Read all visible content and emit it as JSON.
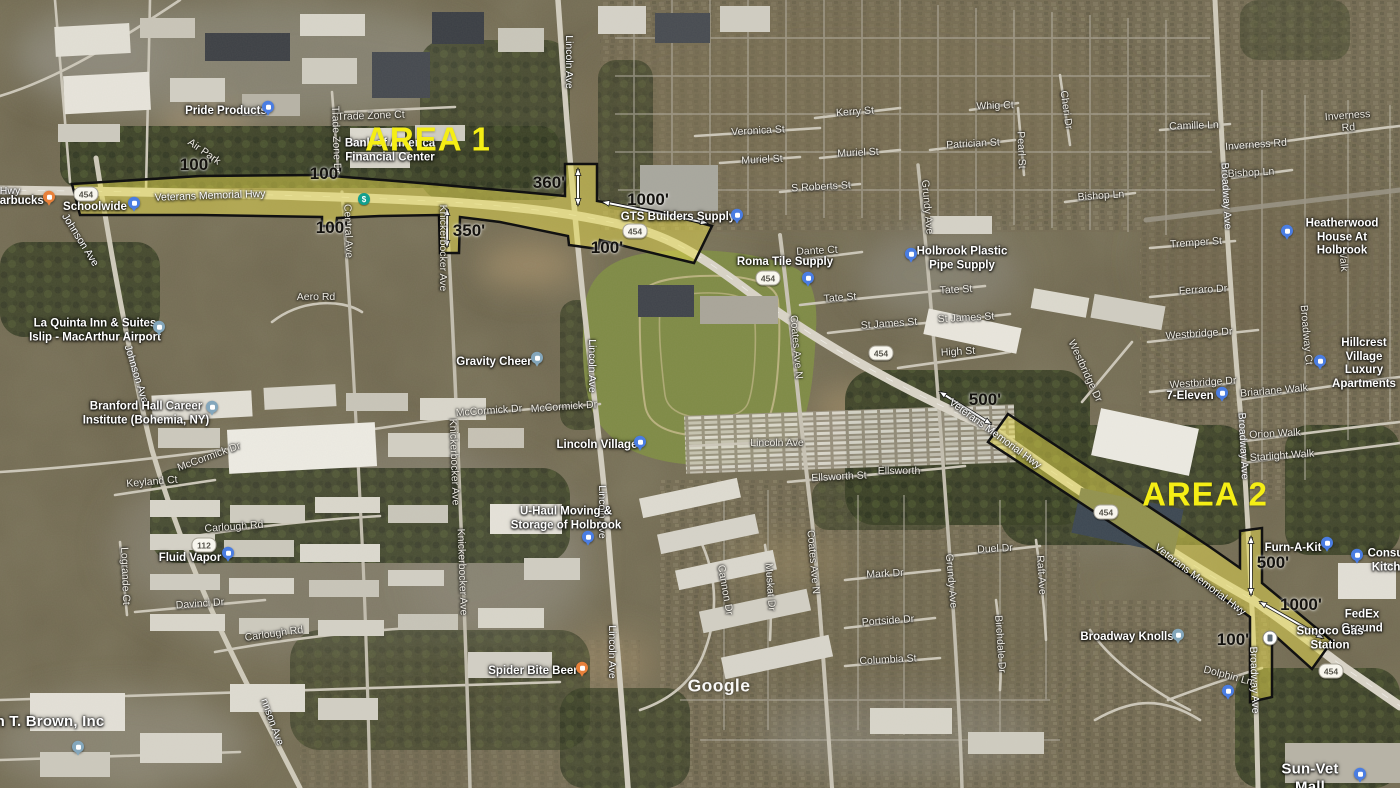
{
  "map": {
    "watermark": "Google",
    "colors": {
      "corridor_fill": "#e8dc4e",
      "corridor_outline": "#111111",
      "area_label": "#f5ee15",
      "arrow": "#ffffff",
      "route_shield_bg": "#f8f6ee"
    },
    "area_labels": [
      {
        "name": "area-1-label",
        "text": "AREA 1",
        "x": 428,
        "y": 140
      },
      {
        "name": "area-2-label",
        "text": "AREA 2",
        "x": 1205,
        "y": 495
      }
    ],
    "measurements": [
      {
        "text": "100'",
        "x": 196,
        "y": 165
      },
      {
        "text": "100'",
        "x": 326,
        "y": 174
      },
      {
        "text": "100'",
        "x": 332,
        "y": 228
      },
      {
        "text": "350'",
        "x": 469,
        "y": 231
      },
      {
        "text": "360'",
        "x": 549,
        "y": 183
      },
      {
        "text": "100'",
        "x": 607,
        "y": 248
      },
      {
        "text": "1000'",
        "x": 648,
        "y": 200
      },
      {
        "text": "500'",
        "x": 985,
        "y": 400
      },
      {
        "text": "500'",
        "x": 1273,
        "y": 563
      },
      {
        "text": "1000'",
        "x": 1301,
        "y": 605
      },
      {
        "text": "100'",
        "x": 1233,
        "y": 640
      }
    ],
    "route_shields": [
      {
        "text": "454",
        "x": 86,
        "y": 194
      },
      {
        "text": "454",
        "x": 635,
        "y": 231
      },
      {
        "text": "454",
        "x": 768,
        "y": 278
      },
      {
        "text": "454",
        "x": 881,
        "y": 353
      },
      {
        "text": "454",
        "x": 1106,
        "y": 512
      },
      {
        "text": "454",
        "x": 1331,
        "y": 671
      },
      {
        "text": "112",
        "x": 204,
        "y": 545
      }
    ],
    "street_labels": [
      {
        "text": "Hwy",
        "x": 10,
        "y": 191,
        "rot": 0,
        "cls": "onroad"
      },
      {
        "text": "Veterans Memorial Hwy",
        "x": 210,
        "y": 196,
        "rot": -2,
        "cls": "onroad"
      },
      {
        "text": "Veterans Memorial Hwy",
        "x": 995,
        "y": 434,
        "rot": 36,
        "cls": "onroad"
      },
      {
        "text": "Veterans Memorial Hwy",
        "x": 1200,
        "y": 580,
        "rot": 37,
        "cls": "onroad"
      },
      {
        "text": "Johnson Ave",
        "x": 80,
        "y": 240,
        "rot": 58,
        "cls": "onroad"
      },
      {
        "text": "Johnson Ave",
        "x": 136,
        "y": 374,
        "rot": 73,
        "cls": "onroad"
      },
      {
        "text": "nnson Ave",
        "x": 272,
        "y": 722,
        "rot": 70,
        "cls": "onroad"
      },
      {
        "text": "Lincoln Ave",
        "x": 569,
        "y": 62,
        "rot": 90,
        "cls": "onroad"
      },
      {
        "text": "Lincoln Ave",
        "x": 592,
        "y": 366,
        "rot": 90,
        "cls": "onroad"
      },
      {
        "text": "Lincoln Ave",
        "x": 602,
        "y": 512,
        "rot": 90,
        "cls": "onroad"
      },
      {
        "text": "Lincoln Ave",
        "x": 612,
        "y": 652,
        "rot": 90,
        "cls": "onroad"
      },
      {
        "text": "Broadway Ave",
        "x": 1226,
        "y": 196,
        "rot": 87,
        "cls": "onroad"
      },
      {
        "text": "Broadway Ave",
        "x": 1243,
        "y": 446,
        "rot": 87,
        "cls": "onroad"
      },
      {
        "text": "Broadway Ave",
        "x": 1254,
        "y": 680,
        "rot": 88,
        "cls": "onroad"
      },
      {
        "text": "Coates Ave N",
        "x": 796,
        "y": 347,
        "rot": 85
      },
      {
        "text": "Coates Ave N",
        "x": 813,
        "y": 562,
        "rot": 85
      },
      {
        "text": "Grundy Ave",
        "x": 927,
        "y": 207,
        "rot": 85
      },
      {
        "text": "Grundy Ave",
        "x": 951,
        "y": 581,
        "rot": 85
      },
      {
        "text": "Knickerbocker Ave",
        "x": 443,
        "y": 248,
        "rot": 90
      },
      {
        "text": "Knickerbocker Ave",
        "x": 454,
        "y": 462,
        "rot": 88
      },
      {
        "text": "Knickerbocker Ave",
        "x": 462,
        "y": 572,
        "rot": 88
      },
      {
        "text": "Central Ave",
        "x": 348,
        "y": 231,
        "rot": 88
      },
      {
        "text": "Trade Zone Dr",
        "x": 336,
        "y": 140,
        "rot": 88
      },
      {
        "text": "Trade Zone Ct",
        "x": 371,
        "y": 116,
        "rot": -2
      },
      {
        "text": "Air Park",
        "x": 204,
        "y": 152,
        "rot": 35
      },
      {
        "text": "Aero Rd",
        "x": 316,
        "y": 297,
        "rot": 0
      },
      {
        "text": "McCormick Dr",
        "x": 209,
        "y": 457,
        "rot": -20
      },
      {
        "text": "McCormick Dr",
        "x": 489,
        "y": 411,
        "rot": -4
      },
      {
        "text": "McCormick Dr",
        "x": 564,
        "y": 407,
        "rot": -4
      },
      {
        "text": "Keyland Ct",
        "x": 152,
        "y": 482,
        "rot": -5
      },
      {
        "text": "Carlough Rd",
        "x": 234,
        "y": 527,
        "rot": -4
      },
      {
        "text": "Carlough Rd",
        "x": 274,
        "y": 634,
        "rot": -8
      },
      {
        "text": "Davinci Dr",
        "x": 200,
        "y": 604,
        "rot": -4
      },
      {
        "text": "Logrande Ct",
        "x": 125,
        "y": 576,
        "rot": 88
      },
      {
        "text": "Veronica St",
        "x": 758,
        "y": 131,
        "rot": -3
      },
      {
        "text": "Muriel St",
        "x": 762,
        "y": 160,
        "rot": -3
      },
      {
        "text": "Muriel St",
        "x": 858,
        "y": 153,
        "rot": -3
      },
      {
        "text": "Kerry St",
        "x": 855,
        "y": 112,
        "rot": -4
      },
      {
        "text": "S Roberts St",
        "x": 821,
        "y": 187,
        "rot": -3
      },
      {
        "text": "Whig Ct",
        "x": 995,
        "y": 106,
        "rot": -2
      },
      {
        "text": "Patrician St",
        "x": 973,
        "y": 144,
        "rot": -3
      },
      {
        "text": "Pearl St",
        "x": 1021,
        "y": 150,
        "rot": 88
      },
      {
        "text": "Cheri Dr",
        "x": 1066,
        "y": 110,
        "rot": 82
      },
      {
        "text": "Camille Ln",
        "x": 1194,
        "y": 126,
        "rot": -2
      },
      {
        "text": "Inverness Rd",
        "x": 1256,
        "y": 145,
        "rot": -4
      },
      {
        "text": "Inverness Rd",
        "x": 1348,
        "y": 122,
        "rot": -4
      },
      {
        "text": "Bishop Ln",
        "x": 1251,
        "y": 173,
        "rot": -3
      },
      {
        "text": "Bishop Ln",
        "x": 1101,
        "y": 196,
        "rot": -4
      },
      {
        "text": "Tremper St",
        "x": 1196,
        "y": 243,
        "rot": -4
      },
      {
        "text": "Ferraro Dr",
        "x": 1203,
        "y": 290,
        "rot": -3
      },
      {
        "text": "Westbridge Dr",
        "x": 1199,
        "y": 334,
        "rot": -4
      },
      {
        "text": "Westbridge Dr",
        "x": 1203,
        "y": 383,
        "rot": -4
      },
      {
        "text": "Westbridge Dr",
        "x": 1085,
        "y": 371,
        "rot": 65
      },
      {
        "text": "Briarlane Walk",
        "x": 1274,
        "y": 391,
        "rot": -5
      },
      {
        "text": "Orion Walk",
        "x": 1275,
        "y": 434,
        "rot": -3
      },
      {
        "text": "Starlight Walk",
        "x": 1282,
        "y": 456,
        "rot": -4
      },
      {
        "text": "Broadway Ct",
        "x": 1306,
        "y": 335,
        "rot": 85
      },
      {
        "text": "Walk",
        "x": 1343,
        "y": 260,
        "rot": 85
      },
      {
        "text": "Dante Ct",
        "x": 817,
        "y": 251,
        "rot": -3
      },
      {
        "text": "Tate St",
        "x": 840,
        "y": 298,
        "rot": -4
      },
      {
        "text": "Tate St",
        "x": 956,
        "y": 290,
        "rot": -3
      },
      {
        "text": "St James St",
        "x": 889,
        "y": 324,
        "rot": -4
      },
      {
        "text": "St James St",
        "x": 966,
        "y": 318,
        "rot": -3
      },
      {
        "text": "High St",
        "x": 958,
        "y": 352,
        "rot": -3
      },
      {
        "text": "Ellsworth St",
        "x": 839,
        "y": 477,
        "rot": -3
      },
      {
        "text": "Ellsworth",
        "x": 899,
        "y": 471,
        "rot": 0
      },
      {
        "text": "Lincoln Ave",
        "x": 777,
        "y": 443,
        "rot": 0
      },
      {
        "text": "Cannon Dr",
        "x": 725,
        "y": 590,
        "rot": 80
      },
      {
        "text": "Muskat Dr",
        "x": 770,
        "y": 587,
        "rot": 86
      },
      {
        "text": "Mark Dr",
        "x": 885,
        "y": 574,
        "rot": -3
      },
      {
        "text": "Duel Dr",
        "x": 995,
        "y": 549,
        "rot": -3
      },
      {
        "text": "Raft Ave",
        "x": 1041,
        "y": 575,
        "rot": 86
      },
      {
        "text": "Portside Dr",
        "x": 888,
        "y": 621,
        "rot": -4
      },
      {
        "text": "Columbia St",
        "x": 888,
        "y": 660,
        "rot": -3
      },
      {
        "text": "Birchdale Dr",
        "x": 1000,
        "y": 644,
        "rot": 86
      },
      {
        "text": "Dolphin Ln",
        "x": 1228,
        "y": 676,
        "rot": 15
      }
    ],
    "pois": [
      {
        "name": "pride-products",
        "text": "Pride Products",
        "x": 226,
        "y": 112
      },
      {
        "name": "starbucks",
        "text": "Starbucks",
        "x": 16,
        "y": 202
      },
      {
        "name": "schoolwide",
        "text": "Schoolwide",
        "x": 95,
        "y": 208
      },
      {
        "name": "bank-of-america",
        "text": "Bank of America\nFinancial Center",
        "x": 390,
        "y": 151
      },
      {
        "name": "la-quinta",
        "text": "La Quinta Inn & Suites\nIslip - MacArthur Airport",
        "x": 95,
        "y": 331
      },
      {
        "name": "branford-hall",
        "text": "Branford Hall Career\nInstitute (Bohemia, NY)",
        "x": 146,
        "y": 414
      },
      {
        "name": "fluid-vapor",
        "text": "Fluid Vapor",
        "x": 190,
        "y": 559
      },
      {
        "name": "t-brown-inc",
        "text": "n T. Brown, Inc",
        "x": 50,
        "y": 722,
        "big": true
      },
      {
        "name": "gravity-cheer",
        "text": "Gravity Cheer",
        "x": 494,
        "y": 363
      },
      {
        "name": "lincoln-village",
        "text": "Lincoln Village",
        "x": 597,
        "y": 446
      },
      {
        "name": "u-haul",
        "text": "U-Haul Moving &\nStorage of Holbrook",
        "x": 566,
        "y": 519
      },
      {
        "name": "spider-bite-beer",
        "text": "Spider Bite Beer",
        "x": 533,
        "y": 672
      },
      {
        "name": "gts-builders-supply",
        "text": "GTS Builders Supply",
        "x": 678,
        "y": 218
      },
      {
        "name": "roma-tile-supply",
        "text": "Roma Tile Supply",
        "x": 785,
        "y": 263
      },
      {
        "name": "holbrook-plastic-pipe-supply",
        "text": "Holbrook Plastic\nPipe Supply",
        "x": 962,
        "y": 259
      },
      {
        "name": "seven-eleven",
        "text": "7-Eleven",
        "x": 1190,
        "y": 397
      },
      {
        "name": "heatherwood-house",
        "text": "Heatherwood\nHouse At Holbrook",
        "x": 1342,
        "y": 238
      },
      {
        "name": "hillcrest-village",
        "text": "Hillcrest Village\nLuxury Apartments",
        "x": 1364,
        "y": 364
      },
      {
        "name": "furn-a-kit",
        "text": "Furn-A-Kit",
        "x": 1293,
        "y": 549
      },
      {
        "name": "consumer-kitchens",
        "text": "Consumer\nKitchens",
        "x": 1396,
        "y": 561
      },
      {
        "name": "fedex-ground",
        "text": "FedEx Ground",
        "x": 1362,
        "y": 622
      },
      {
        "name": "sunoco-gas-station",
        "text": "Sunoco Gas Station",
        "x": 1330,
        "y": 639
      },
      {
        "name": "broadway-knolls",
        "text": "Broadway Knolls",
        "x": 1127,
        "y": 638
      },
      {
        "name": "sun-vet-mall",
        "text": "Sun-Vet Mall",
        "x": 1310,
        "y": 778,
        "big": true
      }
    ],
    "markers": [
      {
        "name": "pride-products",
        "type": "shop",
        "x": 268,
        "y": 108
      },
      {
        "name": "starbucks",
        "type": "food",
        "x": 49,
        "y": 198
      },
      {
        "name": "schoolwide",
        "type": "shop",
        "x": 134,
        "y": 204
      },
      {
        "name": "bank-of-america-atm",
        "type": "atm",
        "x": 364,
        "y": 199
      },
      {
        "name": "la-quinta",
        "type": "poi",
        "x": 159,
        "y": 328
      },
      {
        "name": "branford-hall",
        "type": "poi",
        "x": 212,
        "y": 408
      },
      {
        "name": "fluid-vapor",
        "type": "shop",
        "x": 228,
        "y": 554
      },
      {
        "name": "t-brown-inc",
        "type": "poi",
        "x": 78,
        "y": 748
      },
      {
        "name": "gravity-cheer",
        "type": "poi",
        "x": 537,
        "y": 359
      },
      {
        "name": "lincoln-village",
        "type": "shop",
        "x": 640,
        "y": 443
      },
      {
        "name": "u-haul",
        "type": "shop",
        "x": 588,
        "y": 538
      },
      {
        "name": "spider-bite-beer",
        "type": "food",
        "x": 582,
        "y": 669
      },
      {
        "name": "gts-builders-supply",
        "type": "shop",
        "x": 737,
        "y": 216
      },
      {
        "name": "roma-tile-supply",
        "type": "shop",
        "x": 808,
        "y": 279
      },
      {
        "name": "holbrook-plastic-pipe-supply",
        "type": "shop",
        "x": 911,
        "y": 255
      },
      {
        "name": "seven-eleven",
        "type": "shop",
        "x": 1222,
        "y": 394
      },
      {
        "name": "heatherwood-house",
        "type": "shop",
        "x": 1287,
        "y": 232
      },
      {
        "name": "hillcrest-village",
        "type": "shop",
        "x": 1320,
        "y": 362
      },
      {
        "name": "furn-a-kit",
        "type": "shop",
        "x": 1327,
        "y": 544
      },
      {
        "name": "consumer-kitchens",
        "type": "shop",
        "x": 1357,
        "y": 556
      },
      {
        "name": "sunoco-gas-station",
        "type": "gas",
        "x": 1270,
        "y": 638
      },
      {
        "name": "broadway-knolls",
        "type": "poi",
        "x": 1178,
        "y": 636
      },
      {
        "name": "sun-vet-mall",
        "type": "shop",
        "x": 1360,
        "y": 775
      },
      {
        "name": "unlabeled-business",
        "type": "shop",
        "x": 1228,
        "y": 692
      }
    ]
  }
}
